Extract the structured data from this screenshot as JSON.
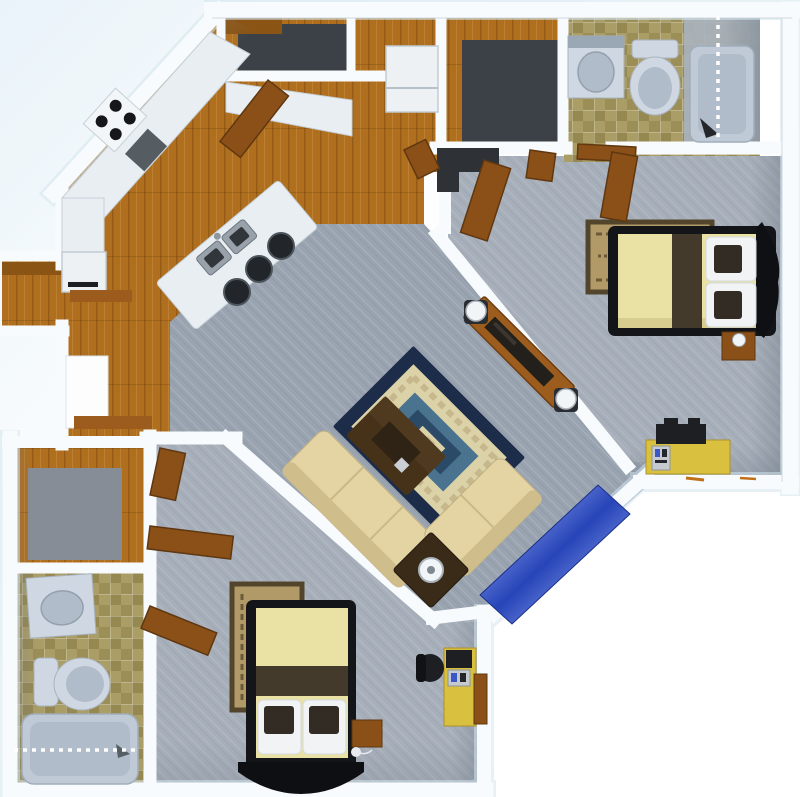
{
  "scene": {
    "kind": "3d-floor-plan-top-view",
    "description": "Two-bedroom two-bath apartment 3D floor plan, top-down render, no text labels",
    "width": 800,
    "height": 797
  },
  "rooms": [
    {
      "name": "kitchen",
      "floor": "wood"
    },
    {
      "name": "entry-closet",
      "floor": "wood-dark"
    },
    {
      "name": "utility-closet",
      "floor": "wood-dark"
    },
    {
      "name": "bathroom-1",
      "floor": "tan-tile"
    },
    {
      "name": "master-bedroom",
      "floor": "gray-carpet"
    },
    {
      "name": "hallway",
      "floor": "gray-carpet"
    },
    {
      "name": "living-room",
      "floor": "gray-carpet"
    },
    {
      "name": "linen-closet",
      "floor": "wood"
    },
    {
      "name": "walk-in-closet",
      "floor": "wood-gray"
    },
    {
      "name": "bathroom-2",
      "floor": "tan-tile"
    },
    {
      "name": "bedroom-2",
      "floor": "gray-carpet"
    }
  ],
  "furniture": [
    "cooktop-4-burners",
    "counter-sink-inset",
    "kitchen-counters",
    "refrigerator",
    "kitchen-island",
    "island-double-sink",
    "bar-stool",
    "bar-stool",
    "bar-stool",
    "washer",
    "wall-shelf",
    "wall-shelf",
    "vanity-sink",
    "toilet",
    "bathtub",
    "shower-curtain",
    "vanity-sink",
    "toilet",
    "bathtub",
    "shower-curtain",
    "double-bed",
    "area-rug",
    "nightstand",
    "desk",
    "computer-printer",
    "double-bed",
    "area-rug",
    "nightstand",
    "desk",
    "computer",
    "office-chair",
    "sectional-sofa",
    "corner-table-lamp",
    "coffee-table",
    "living-rug",
    "console-table",
    "table-lamp",
    "table-lamp",
    "blue-floor-runner",
    "open-door",
    "open-door",
    "open-door",
    "open-door",
    "open-door",
    "open-door",
    "open-door",
    "dark-bench"
  ],
  "palette": {
    "bg_tint": "#e9f3f9",
    "bg_white": "#ffffff",
    "wall": "#f8fbfd",
    "wall_halo": "#d3e5ee",
    "wall_shade": "#c2ccd4",
    "wood": "#b06f1e",
    "wood_dark": "#8a5415",
    "door_wood": "#8a5018",
    "closet_dark": "#3c4147",
    "carpet_living": "#9aa4b1",
    "carpet_bedroom": "#a7afba",
    "tile": "#ab9d66",
    "tile_alt": "#968851",
    "fixture": "#cfd8e2",
    "fixture_dark": "#b0bcc9",
    "tub": "#bfcad6",
    "counter": "#e9eef3",
    "steel": "#99a2aa",
    "steel_dark": "#31363b",
    "stool": "#22262b",
    "fridge": "#eef1f4",
    "bed_frame": "#141519",
    "duvet": "#e9e2a4",
    "bed_runner": "#433a2c",
    "pillow": "#f1f3f5",
    "pillow_inset": "#332c24",
    "rug_tan": "#b19a68",
    "rug_tan_border": "#53452c",
    "sofa": "#e4d4a4",
    "sofa_back": "#cfbd8c",
    "lr_rug_border": "#1d2c49",
    "lr_rug_field": "#dcd2a8",
    "lr_rug_blue1": "#4a7390",
    "lr_rug_blue2": "#2b4a68",
    "lr_rug_tan": "#c6b88c",
    "coffee_table": "#463219",
    "coffee_table_dark": "#2f2315",
    "console_wood": "#9c5c1d",
    "desk_yellow": "#d9c13f",
    "device_dark": "#1d1f22",
    "device_silver": "#c4cad0",
    "lamp_white": "#f2f5f7",
    "mat_blue_a": "#2745b8",
    "mat_blue_b": "#7288e0",
    "pencil_orange": "#c07018",
    "shadow_gray": "#6e7a86"
  }
}
